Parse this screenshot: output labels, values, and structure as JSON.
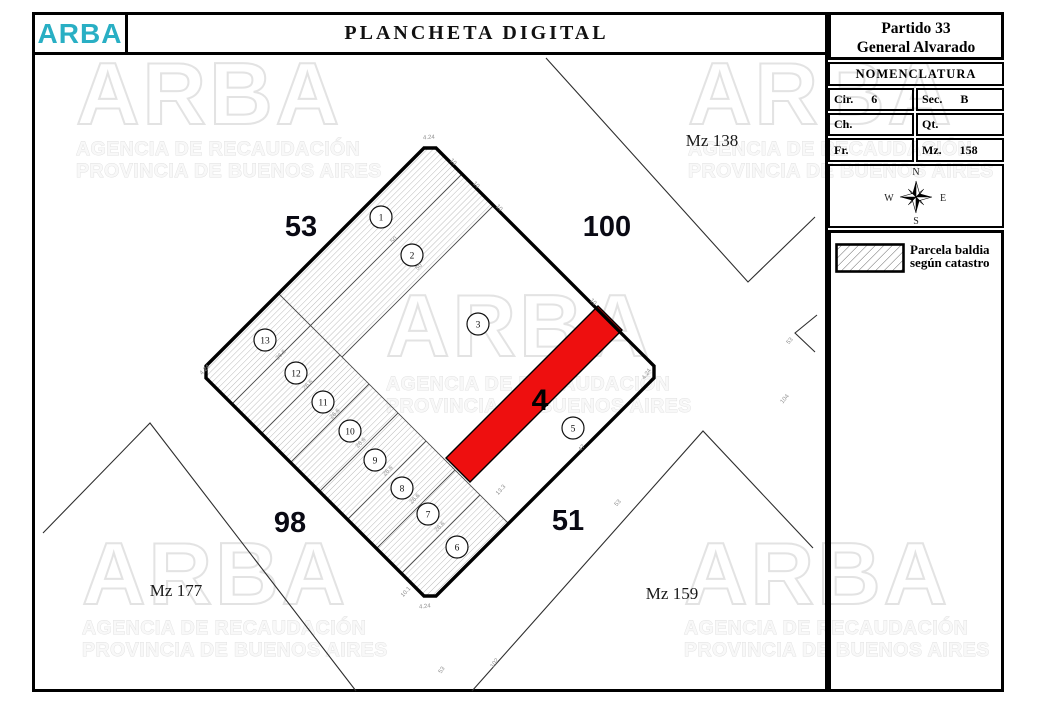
{
  "header": {
    "logo": "ARBA",
    "title": "PLANCHETA DIGITAL"
  },
  "sidebar": {
    "partido_line1": "Partido 33",
    "partido_line2": "General Alvarado",
    "nomenclatura_title": "NOMENCLATURA",
    "fields": [
      {
        "label": "Cir.",
        "value": "6"
      },
      {
        "label": "Sec.",
        "value": "B"
      },
      {
        "label": "Ch.",
        "value": ""
      },
      {
        "label": "Qt.",
        "value": ""
      },
      {
        "label": "Fr.",
        "value": ""
      },
      {
        "label": "Mz.",
        "value": "158"
      }
    ],
    "compass": {
      "n": "N",
      "e": "E",
      "s": "S",
      "w": "W"
    },
    "legend": {
      "line1": "Parcela baldia",
      "line2": "según catastro"
    }
  },
  "map": {
    "highlighted_lot_label": "4",
    "street_labels": [
      {
        "text": "53",
        "x": 301,
        "y": 236
      },
      {
        "text": "100",
        "x": 607,
        "y": 236
      },
      {
        "text": "98",
        "x": 290,
        "y": 532
      },
      {
        "text": "51",
        "x": 568,
        "y": 530
      }
    ],
    "block_labels": [
      {
        "text": "Mz 138",
        "x": 712,
        "y": 146
      },
      {
        "text": "Mz 177",
        "x": 176,
        "y": 596
      },
      {
        "text": "Mz 159",
        "x": 672,
        "y": 599
      }
    ],
    "lots": [
      {
        "num": "1",
        "cx": 381,
        "cy": 217
      },
      {
        "num": "2",
        "cx": 412,
        "cy": 255
      },
      {
        "num": "3",
        "cx": 478,
        "cy": 324
      },
      {
        "num": "5",
        "cx": 573,
        "cy": 428
      },
      {
        "num": "6",
        "cx": 457,
        "cy": 547
      },
      {
        "num": "7",
        "cx": 428,
        "cy": 514
      },
      {
        "num": "8",
        "cx": 402,
        "cy": 488
      },
      {
        "num": "9",
        "cx": 375,
        "cy": 460
      },
      {
        "num": "10",
        "cx": 350,
        "cy": 431
      },
      {
        "num": "11",
        "cx": 323,
        "cy": 402
      },
      {
        "num": "12",
        "cx": 296,
        "cy": 373
      },
      {
        "num": "13",
        "cx": 265,
        "cy": 340
      }
    ],
    "dims": [
      {
        "text": "4.24",
        "x": 429,
        "y": 139,
        "rot": -4
      },
      {
        "text": "10",
        "x": 452,
        "y": 163,
        "rot": 45
      },
      {
        "text": "10",
        "x": 475,
        "y": 186,
        "rot": 45
      },
      {
        "text": "10",
        "x": 498,
        "y": 209,
        "rot": 45
      },
      {
        "text": "10",
        "x": 592,
        "y": 303,
        "rot": 45
      },
      {
        "text": "4.24",
        "x": 648,
        "y": 375,
        "rot": -55
      },
      {
        "text": "47",
        "x": 583,
        "y": 449,
        "rot": -48
      },
      {
        "text": "13.3",
        "x": 502,
        "y": 491,
        "rot": -48
      },
      {
        "text": "50",
        "x": 395,
        "y": 241,
        "rot": -45
      },
      {
        "text": "50",
        "x": 420,
        "y": 268,
        "rot": -45
      },
      {
        "text": "26.6",
        "x": 282,
        "y": 356,
        "rot": -45
      },
      {
        "text": "26.6",
        "x": 309,
        "y": 386,
        "rot": -45
      },
      {
        "text": "26.6",
        "x": 336,
        "y": 415,
        "rot": -45
      },
      {
        "text": "26.6",
        "x": 362,
        "y": 444,
        "rot": -45
      },
      {
        "text": "26.6",
        "x": 389,
        "y": 472,
        "rot": -45
      },
      {
        "text": "26.6",
        "x": 416,
        "y": 500,
        "rot": -45
      },
      {
        "text": "26.6",
        "x": 441,
        "y": 528,
        "rot": -45
      },
      {
        "text": "4.24",
        "x": 206,
        "y": 371,
        "rot": -45
      },
      {
        "text": "10.1",
        "x": 407,
        "y": 593,
        "rot": -48
      },
      {
        "text": "4.24",
        "x": 425,
        "y": 608,
        "rot": -6
      },
      {
        "text": "53",
        "x": 619,
        "y": 504,
        "rot": -48
      },
      {
        "text": "53",
        "x": 443,
        "y": 671,
        "rot": -55
      },
      {
        "text": "102",
        "x": 496,
        "y": 664,
        "rot": -55
      },
      {
        "text": "104",
        "x": 786,
        "y": 400,
        "rot": -50
      },
      {
        "text": "53",
        "x": 791,
        "y": 342,
        "rot": -50
      }
    ]
  },
  "watermark": {
    "brand": "ARBA",
    "line1": "AGENCIA DE RECAUDACIÓN",
    "line2": "PROVINCIA DE BUENOS AIRES"
  },
  "colors": {
    "highlight_red": "#ee0f0f",
    "brand_teal": "#29afc4"
  }
}
